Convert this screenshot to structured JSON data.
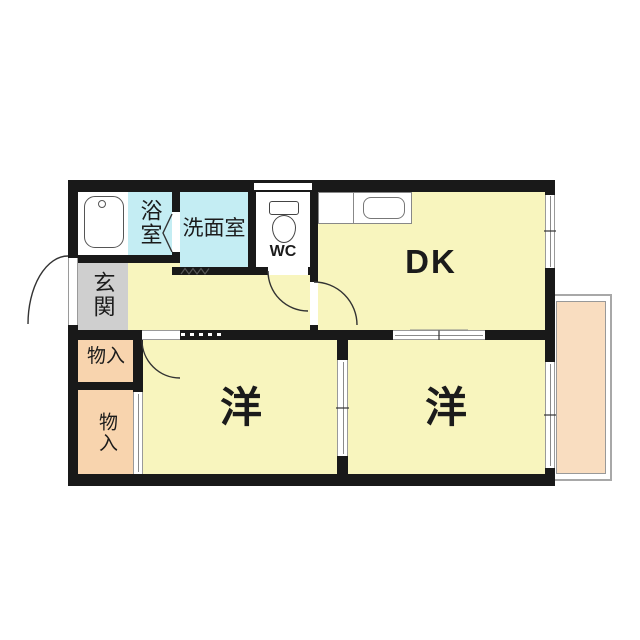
{
  "colors": {
    "room_yellow": "#F8F5BE",
    "wet_cyan": "#C4EDF3",
    "storage_peach": "#F8D4AE",
    "balcony_peach": "#F9DDC0",
    "entrance_gray": "#CFCFCF",
    "wall_black": "#191919"
  },
  "rooms": {
    "dining_kitchen": {
      "label": "DK"
    },
    "bathroom": {
      "label": "浴室"
    },
    "washroom": {
      "label": "洗面室"
    },
    "toilet": {
      "label": "WC"
    },
    "entrance": {
      "label": "玄関"
    },
    "storage_upper": {
      "label": "物入"
    },
    "storage_lower": {
      "label": "物入"
    },
    "western_room_left": {
      "label": "洋"
    },
    "western_room_right": {
      "label": "洋"
    }
  },
  "icons": {
    "bathtub": "bathtub-icon",
    "toilet": "toilet-icon",
    "kitchen_sink": "kitchen-sink-icon",
    "door_swing": "door-swing-arc-icon",
    "folding_door": "folding-door-chevron-icon",
    "accordion_entry": "zigzag-entry-icon"
  }
}
